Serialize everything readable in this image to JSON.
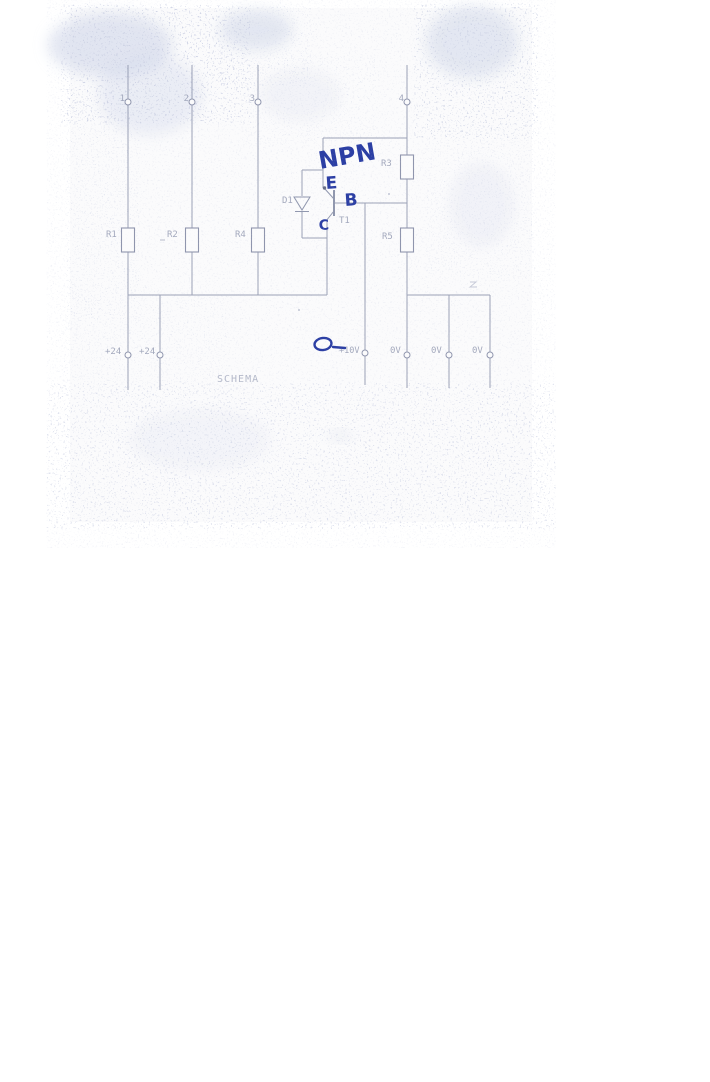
{
  "scan": {
    "caption": "SCHEMA",
    "terminals_top": [
      {
        "label": "1"
      },
      {
        "label": "2"
      },
      {
        "label": "3"
      },
      {
        "label": "4"
      }
    ],
    "terminals_bottom": [
      {
        "label": "+24"
      },
      {
        "label": "+24"
      },
      {
        "label": "+10V"
      },
      {
        "label": "0V"
      },
      {
        "label": "0V"
      },
      {
        "label": "0V"
      }
    ],
    "components": [
      {
        "ref": "R1",
        "type": "resistor"
      },
      {
        "ref": "R2",
        "type": "resistor"
      },
      {
        "ref": "R3",
        "type": "resistor"
      },
      {
        "ref": "R4",
        "type": "resistor"
      },
      {
        "ref": "R5",
        "type": "resistor"
      },
      {
        "ref": "D1",
        "type": "diode"
      },
      {
        "ref": "T1",
        "type": "transistor"
      }
    ],
    "handwritten": {
      "transistor_type": "NPN",
      "emitter": "E",
      "base": "B",
      "collector": "C"
    },
    "colors": {
      "print_line": "#9097ae",
      "print_text": "#9aa0b6",
      "handwriting_ink": "#2c3fa4",
      "paper": "#fbfbfc"
    }
  }
}
